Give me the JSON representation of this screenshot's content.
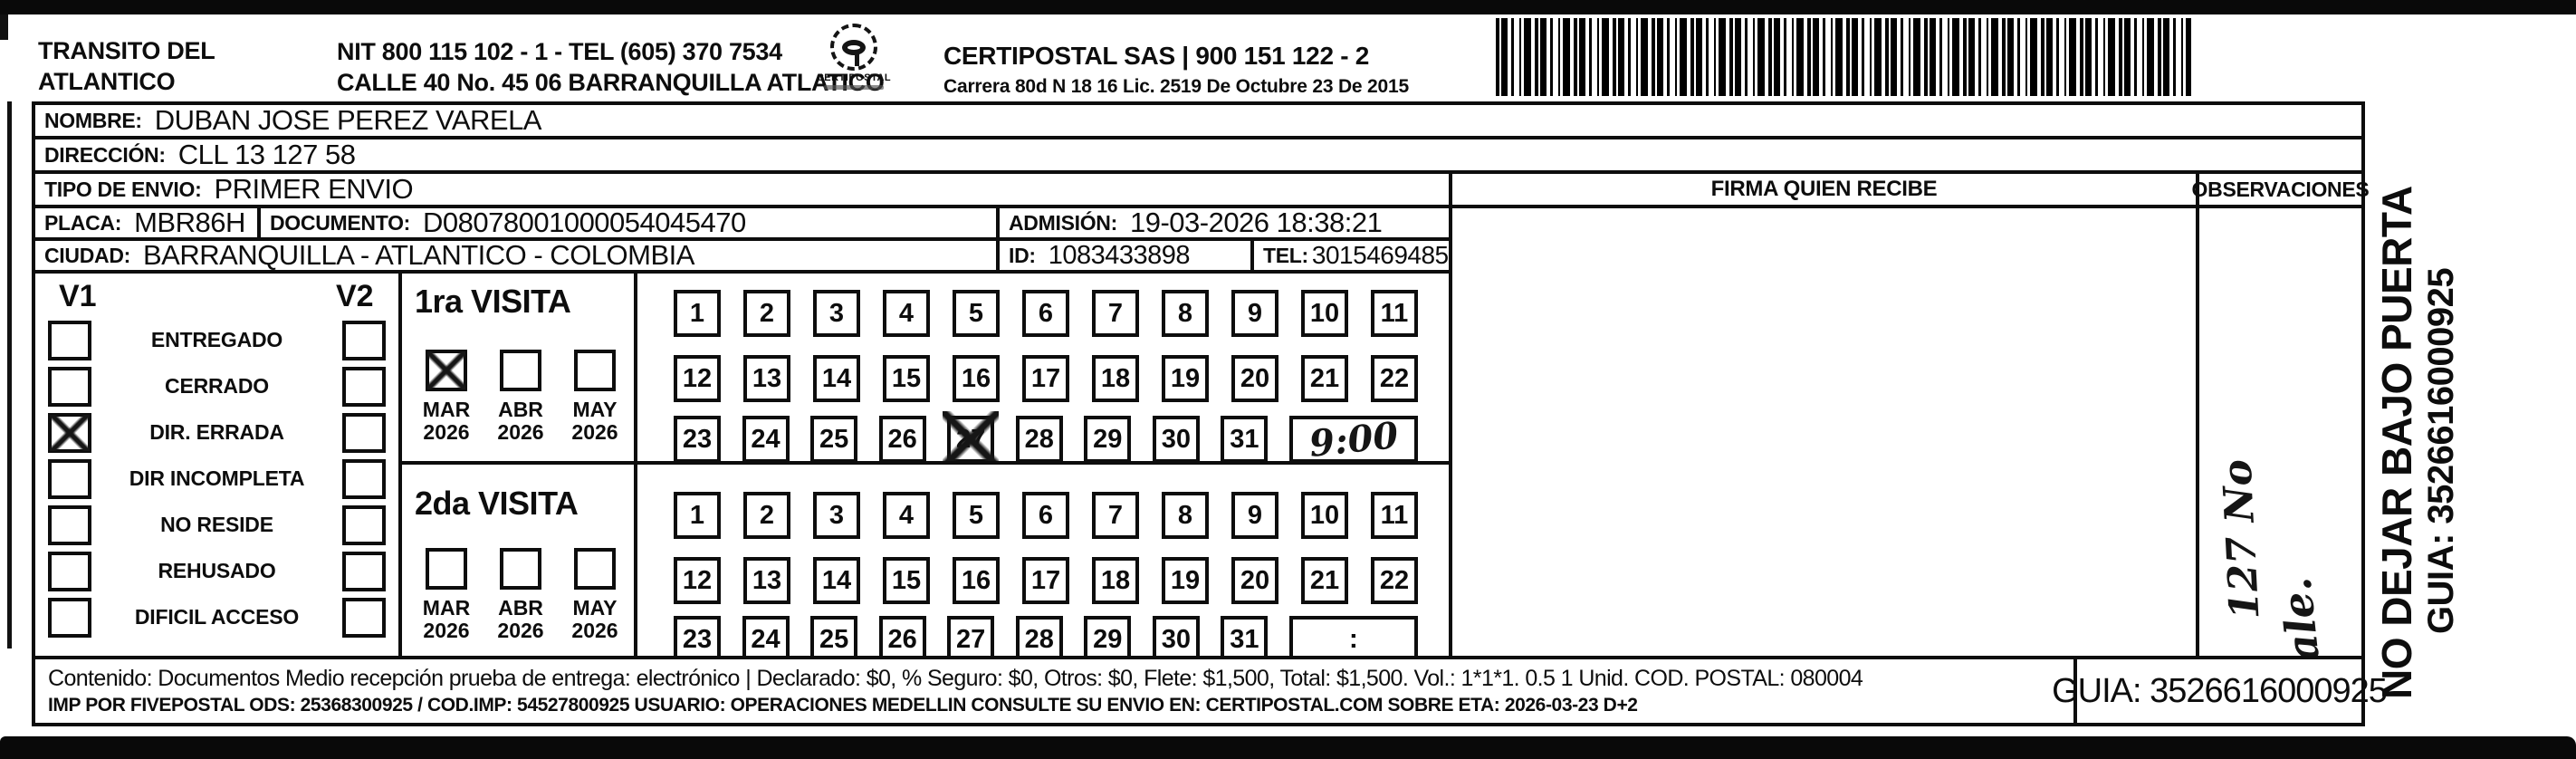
{
  "header": {
    "company_line1": "TRANSITO DEL",
    "company_line2": "ATLANTICO",
    "nit_line": "NIT 800 115 102 - 1 - TEL (605) 370 7534",
    "calle_line": "CALLE 40 No. 45 06 BARRANQUILLA ATLATICO",
    "logo_text": "CERTIPOSTAL",
    "right_name": "CERTIPOSTAL SAS | 900 151 122 - 2",
    "right_sub": "Carrera 80d N 18 16  Lic. 2519 De Octubre 23 De 2015"
  },
  "rows": {
    "nombre_label": "NOMBRE:",
    "nombre_value": "DUBAN JOSE PEREZ VARELA",
    "direccion_label": "DIRECCIÓN:",
    "direccion_value": "CLL 13 127 58",
    "tipo_label": "TIPO DE ENVIO:",
    "tipo_value": "PRIMER ENVIO",
    "placa_label": "PLACA:",
    "placa_value": "MBR86H",
    "documento_label": "DOCUMENTO:",
    "documento_value": "D08078001000054045470",
    "admision_label": "ADMISIÓN:",
    "admision_value": "19-03-2026 18:38:21",
    "ciudad_label": "CIUDAD:",
    "ciudad_value": "BARRANQUILLA - ATLANTICO - COLOMBIA",
    "id_label": "ID:",
    "id_value": "1083433898",
    "tel_label": "TEL:",
    "tel_value": "3015469485"
  },
  "status": {
    "v1_label": "V1",
    "v2_label": "V2",
    "options": [
      {
        "label": "ENTREGADO",
        "v1": false,
        "v2": false
      },
      {
        "label": "CERRADO",
        "v1": false,
        "v2": false
      },
      {
        "label": "DIR. ERRADA",
        "v1": true,
        "v2": false
      },
      {
        "label": "DIR INCOMPLETA",
        "v1": false,
        "v2": false
      },
      {
        "label": "NO RESIDE",
        "v1": false,
        "v2": false
      },
      {
        "label": "REHUSADO",
        "v1": false,
        "v2": false
      },
      {
        "label": "DIFICIL ACCESO",
        "v1": false,
        "v2": false
      }
    ]
  },
  "visits": {
    "first": {
      "title": "1ra VISITA",
      "months": [
        {
          "label": "MAR",
          "year": "2026",
          "checked": true
        },
        {
          "label": "ABR",
          "year": "2026",
          "checked": false
        },
        {
          "label": "MAY",
          "year": "2026",
          "checked": false
        }
      ],
      "day_rows": [
        [
          1,
          2,
          3,
          4,
          5,
          6,
          7,
          8,
          9,
          10,
          11
        ],
        [
          12,
          13,
          14,
          15,
          16,
          17,
          18,
          19,
          20,
          21,
          22
        ],
        [
          23,
          24,
          25,
          26,
          27,
          28,
          29,
          30,
          31
        ]
      ],
      "marked_day": 27,
      "time": "9:00",
      "time_handwritten": true
    },
    "second": {
      "title": "2da VISITA",
      "months": [
        {
          "label": "MAR",
          "year": "2026",
          "checked": false
        },
        {
          "label": "ABR",
          "year": "2026",
          "checked": false
        },
        {
          "label": "MAY",
          "year": "2026",
          "checked": false
        }
      ],
      "day_rows": [
        [
          1,
          2,
          3,
          4,
          5,
          6,
          7,
          8,
          9,
          10,
          11
        ],
        [
          12,
          13,
          14,
          15,
          16,
          17,
          18,
          19,
          20,
          21,
          22
        ],
        [
          23,
          24,
          25,
          26,
          27,
          28,
          29,
          30,
          31
        ]
      ],
      "marked_day": null,
      "time": ":",
      "time_handwritten": false
    }
  },
  "columns": {
    "firma_header": "FIRMA QUIEN RECIBE",
    "observaciones_header": "OBSERVACIONES"
  },
  "obs_note": {
    "line1": "127 No",
    "line2": "Sale."
  },
  "side": {
    "line1": "NO DEJAR BAJO PUERTA",
    "line2": "GUIA: 3526616000925"
  },
  "footer": {
    "line1": "Contenido: Documentos Medio recepción prueba de entrega: electrónico | Declarado: $0, % Seguro: $0, Otros: $0, Flete: $1,500, Total: $1,500. Vol.: 1*1*1. 0.5  1 Unid. COD. POSTAL: 080004",
    "line2": "IMP POR FIVEPOSTAL ODS: 25368300925 / COD.IMP: 54527800925 USUARIO: OPERACIONES MEDELLIN CONSULTE SU ENVIO EN: CERTIPOSTAL.COM SOBRE ETA: 2026-03-23 D+2",
    "guia": "GUIA: 3526616000925"
  }
}
